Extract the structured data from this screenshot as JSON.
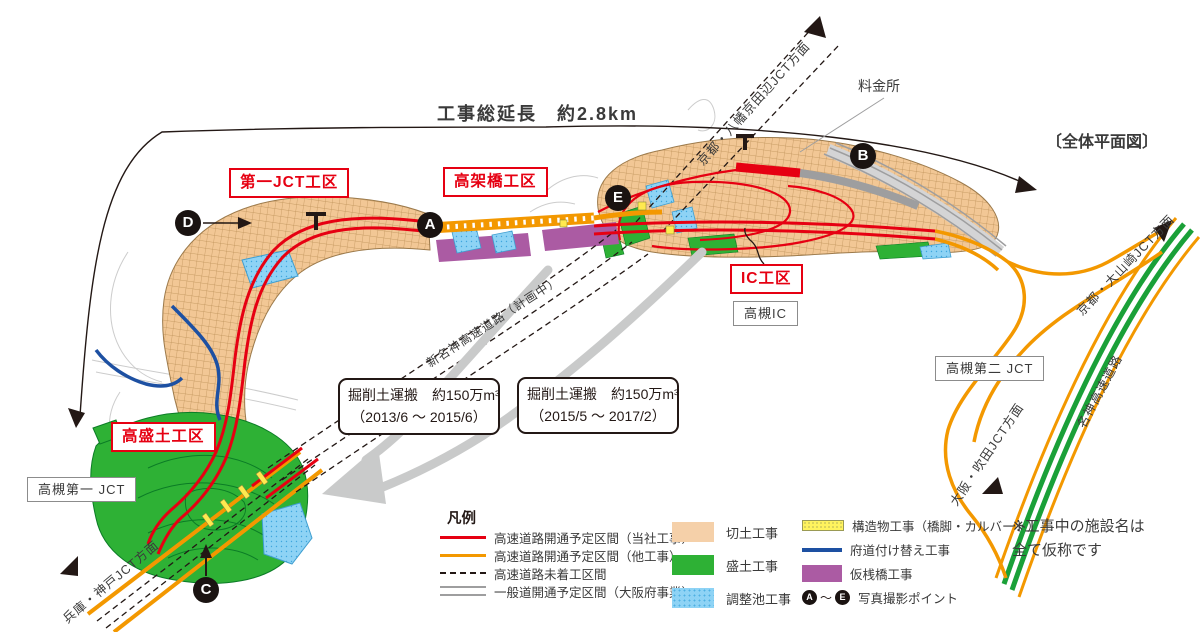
{
  "header": {
    "total_length": "工事総延長　約2.8km",
    "plan_view": "〔全体平面図〕"
  },
  "map": {
    "toll_gate": "料金所",
    "shinmeishin_planned": "新名神高速道路（計画中）",
    "meishin": "名神高速道路"
  },
  "directions": {
    "kyoto_yawata": "京都・八幡京田辺JCT方面",
    "kyoto_oyamazaki": "京都・大山崎JCT方面",
    "osaka_suita": "大阪・吹田JCT方面",
    "hyogo_kobe": "兵庫・神戸JCT方面"
  },
  "zones": [
    "第一JCT工区",
    "高架橋工区",
    "IC工区",
    "高盛土工区"
  ],
  "facilities": [
    "高槻IC",
    "高槻第二 JCT",
    "高槻第一 JCT"
  ],
  "callouts": [
    {
      "text": "掘削土運搬　約150万m³",
      "period": "（2013/6 ～ 2015/6）"
    },
    {
      "text": "掘削土運搬　約150万m³",
      "period": "（2015/5 ～ 2017/2）"
    }
  ],
  "photo_points": [
    "A",
    "B",
    "C",
    "D",
    "E"
  ],
  "legend": {
    "header": "凡例",
    "lines": [
      {
        "label": "高速道路開通予定区間（当社工事）",
        "color": "#e60012",
        "style": "solid"
      },
      {
        "label": "高速道路開通予定区間（他工事）",
        "color": "#f39800",
        "style": "solid"
      },
      {
        "label": "高速道路未着工区間",
        "color": "#231815",
        "style": "dashed"
      },
      {
        "label": "一般道開通予定区間（大阪府事業）",
        "color": "#9e9e9f",
        "style": "double"
      }
    ],
    "areas": [
      {
        "label": "切土工事",
        "color": "#f5d0a9"
      },
      {
        "label": "盛土工事",
        "color": "#2eb135"
      },
      {
        "label": "調整池工事",
        "color": "#8ed3f5"
      }
    ],
    "others": [
      {
        "label": "構造物工事（橋脚・カルバート）",
        "color": "#fff35e"
      },
      {
        "label": "府道付け替え工事",
        "color": "#1d50a2"
      },
      {
        "label": "仮桟橋工事",
        "color": "#ab5ba3"
      },
      {
        "label": "写真撮影ポイント"
      }
    ],
    "points_tilde": "～",
    "note1": "※工事中の施設名は",
    "note2": "全て仮称です"
  }
}
